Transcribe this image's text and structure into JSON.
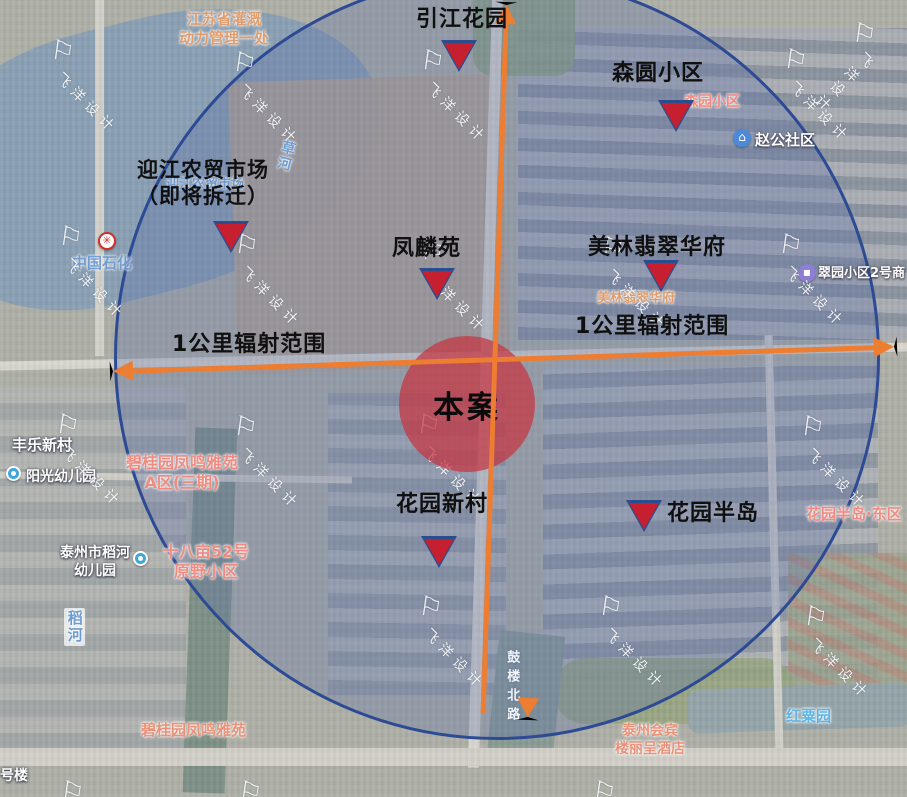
{
  "annotations": {
    "site_label": "本案",
    "radius_label_left": "1公里辐射范围",
    "radius_label_right": "1公里辐射范围",
    "markers": [
      {
        "label": "引江花园"
      },
      {
        "label": "森圆小区"
      },
      {
        "label": "迎江农贸市场\n（即将拆迁）"
      },
      {
        "label": "凤麟苑"
      },
      {
        "label": "美林翡翠华府"
      },
      {
        "label": "花园新村"
      },
      {
        "label": "花园半岛"
      }
    ]
  },
  "base_map_labels": {
    "irrigation_office": "江苏省灌溉\n动力管理一处",
    "senyuan_estate": "森园小区",
    "zhaogong_community": "赵公社区",
    "yingjiang_market": "迎江农贸市场",
    "cao_river": "草河",
    "sinopec": "中国石化",
    "cuiyuan_shops": "翠园小区2号商",
    "meilin_estate": "美林翡翠华府",
    "fengle_village": "丰乐新村",
    "sunshine_kindergarten": "阳光幼儿园",
    "bgy_phase3": "碧桂园凤鸣雅苑\nA区(三期)",
    "daohe_kindergarten": "泰州市稻河\n幼儿园",
    "shibamu_estate": "十八亩52号\n原野小区",
    "huayuan_peninsula_east": "花园半岛·东区",
    "dao_river": "稻河",
    "gulou_north_road": "鼓楼北路",
    "bgy_estate": "碧桂园凤鸣雅苑",
    "huibin_hotel": "泰州会宾\n楼丽呈酒店",
    "hongsu_garden": "红粟园",
    "building_no_partial": "号楼",
    "community_icon_glyph": "⌂",
    "sinopec_icon_glyph": "✳",
    "shop_icon_glyph": "▪"
  },
  "watermark": {
    "text": "飞洋设计",
    "flag_glyph": "⚐"
  },
  "colors": {
    "accent_orange": "#ED7D31",
    "radius_circle_border": "#2D4A94",
    "radius_circle_fill": "rgba(88,108,170,0.30)",
    "marker_red": "#C51F30",
    "marker_outline_blue": "#2B4D8E",
    "site_circle_fill": "rgba(198,52,64,0.72)",
    "map_label_pink": "#EF8B80",
    "map_label_tan": "#DD9D6F",
    "map_label_blue": "#6E9CD2",
    "annotation_black": "#101010"
  }
}
